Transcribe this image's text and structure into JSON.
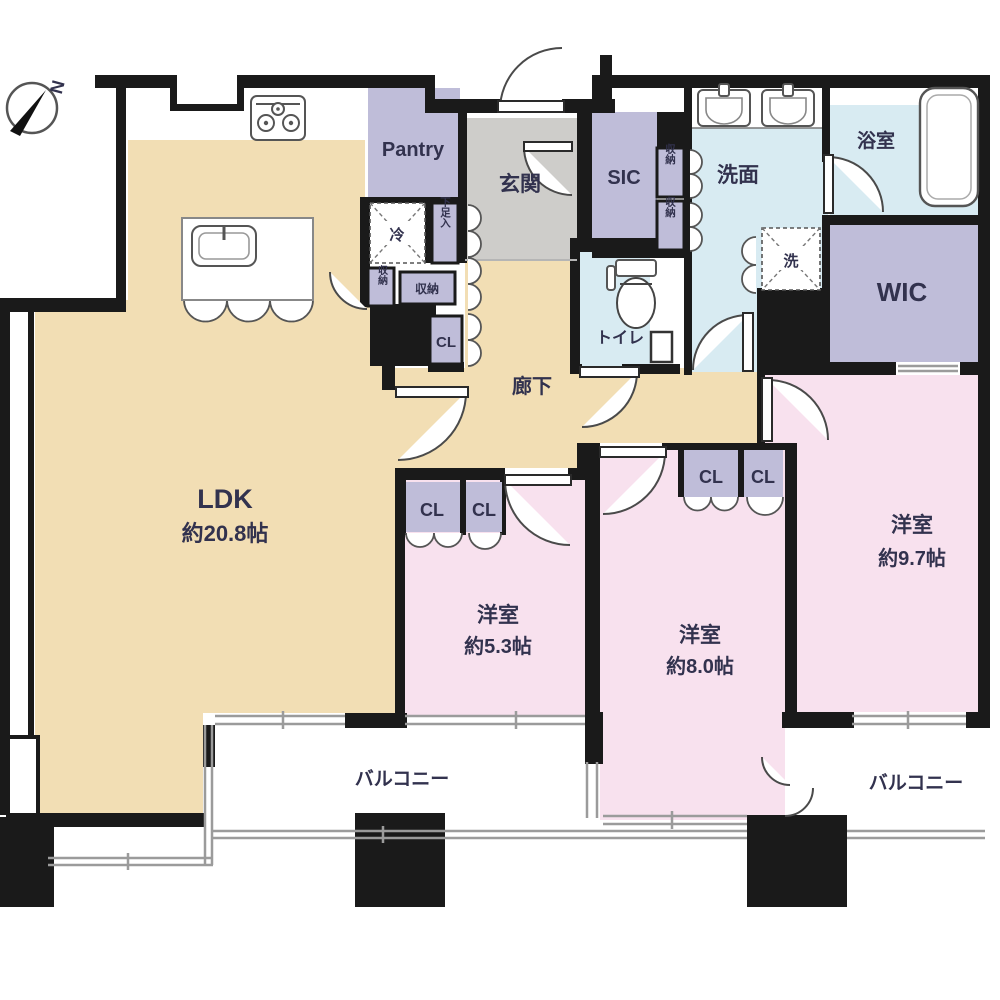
{
  "compass": {
    "north_label": "N"
  },
  "rooms": {
    "ldk": {
      "label": "LDK",
      "size": "約20.8帖"
    },
    "pantry": {
      "label": "Pantry"
    },
    "genkan": {
      "label": "玄関"
    },
    "sic": {
      "label": "SIC"
    },
    "senmen": {
      "label": "洗面"
    },
    "bath": {
      "label": "浴室"
    },
    "wic": {
      "label": "WIC"
    },
    "toilet": {
      "label": "トイレ"
    },
    "hallway": {
      "label": "廊下"
    },
    "west_room_small": {
      "label": "洋室",
      "size": "約5.3帖"
    },
    "west_room_mid": {
      "label": "洋室",
      "size": "約8.0帖"
    },
    "west_room_large": {
      "label": "洋室",
      "size": "約9.7帖"
    },
    "balcony_left": {
      "label": "バルコニー"
    },
    "balcony_right": {
      "label": "バルコニー"
    }
  },
  "fixtures": {
    "refrigerator_label": "冷",
    "shoe_storage_label": "下足入",
    "storage_label": "収納",
    "closet_label": "CL",
    "washer_label": "洗"
  },
  "colors": {
    "wall": "#1a1a1a",
    "ldk_floor": "#f2deb4",
    "bedroom_floor": "#f8e1ee",
    "closet_fill": "#bfbdd9",
    "wet_area_floor": "#d8ebf2",
    "entrance_floor": "#cecdca",
    "railing": "#9b9b9b",
    "label_text": "#32324e"
  }
}
